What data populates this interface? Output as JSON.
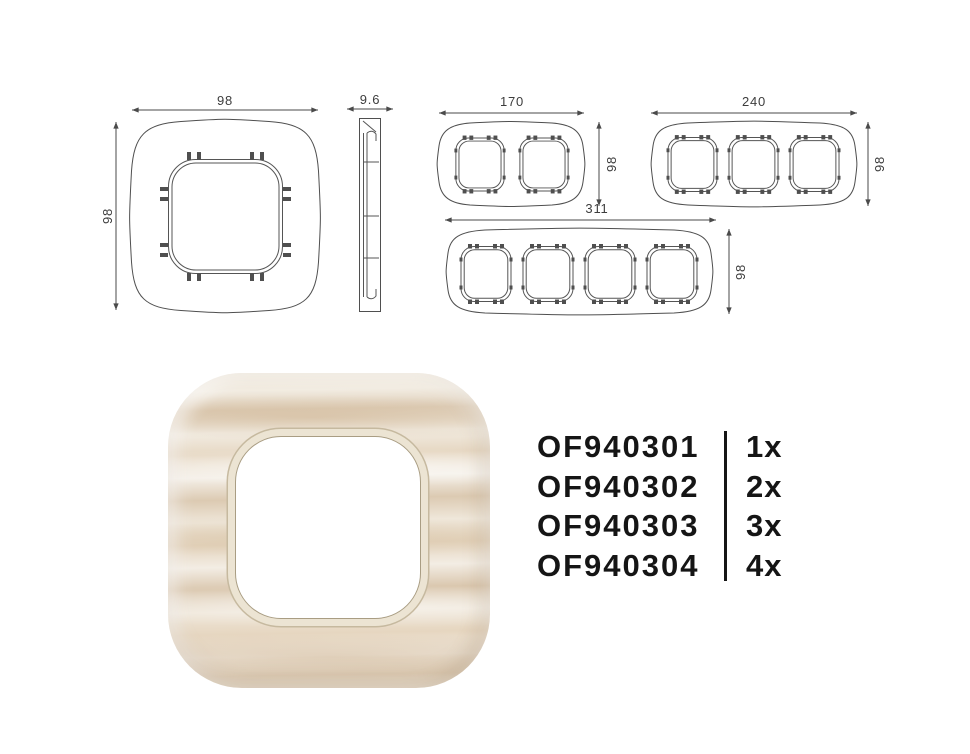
{
  "colors": {
    "background": "#ffffff",
    "drawing_line": "#4a4a4a",
    "dimension_text": "#3d3d3d",
    "order_text": "#151515",
    "wood_light": "#f3ede4",
    "wood_mid": "#e6d6c0",
    "wood_dark": "#d9c6ae",
    "opening_ring": "#ece4d3"
  },
  "technical_drawings": {
    "single_front": {
      "width_label": "98",
      "height_label": "98"
    },
    "single_side": {
      "thickness_label": "9.6"
    },
    "double_front": {
      "width_label": "170",
      "height_label": "98"
    },
    "triple_front": {
      "width_label": "240",
      "height_label": "98"
    },
    "quad_front": {
      "width_label": "311",
      "height_label": "98"
    }
  },
  "order_table": {
    "rows": [
      {
        "code": "OF940301",
        "qty": "1x"
      },
      {
        "code": "OF940302",
        "qty": "2x"
      },
      {
        "code": "OF940303",
        "qty": "3x"
      },
      {
        "code": "OF940304",
        "qty": "4x"
      }
    ]
  }
}
